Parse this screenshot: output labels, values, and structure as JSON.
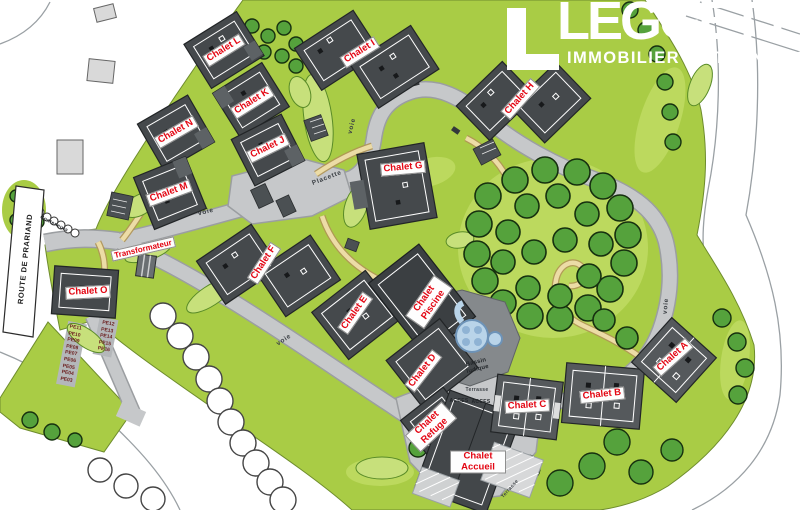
{
  "logo": {
    "brand": "LEGGETT",
    "tagline": "IMMOBILIER INTERNATIONAL"
  },
  "labels": {
    "chalets": [
      {
        "name": "Chalet A"
      },
      {
        "name": "Chalet B"
      },
      {
        "name": "Chalet C"
      },
      {
        "name": "Chalet D"
      },
      {
        "name": "Chalet E"
      },
      {
        "name": "Chalet F"
      },
      {
        "name": "Chalet G"
      },
      {
        "name": "Chalet H"
      },
      {
        "name": "Chalet I"
      },
      {
        "name": "Chalet J"
      },
      {
        "name": "Chalet K"
      },
      {
        "name": "Chalet L"
      },
      {
        "name": "Chalet M"
      },
      {
        "name": "Chalet N"
      },
      {
        "name": "Chalet O"
      },
      {
        "name": "Chalet Piscine"
      },
      {
        "name": "Chalet Refuge"
      },
      {
        "name": "Chalet Accueil"
      }
    ],
    "transformer": "Transformateur",
    "road": {
      "route_de_prariand": "ROUTE DE PRARIAND",
      "voie": "voie",
      "placette": "Placette",
      "conteneurs": "Conteneurs",
      "acces": "ACCES"
    },
    "amenities": {
      "bassin_ludique": "Bassin ludique",
      "terrasse": "Terrasse"
    },
    "parking": {
      "west_left": [
        "PE11",
        "PE10",
        "PE09",
        "PE08",
        "PE07",
        "PE06",
        "PE05",
        "PE04",
        "PE03"
      ],
      "west_right": [
        "PE12",
        "PE13",
        "PE14",
        "PE15",
        "PE16"
      ]
    }
  },
  "colors": {
    "site_green": "#a9cc45",
    "shrub_green": "#c7e07b",
    "tree_green": "#55a23c",
    "road_gray": "#c6c8ca",
    "building_gray": "#45494c",
    "label_red": "#e30613",
    "pool_blue": "#b9d4e9"
  }
}
